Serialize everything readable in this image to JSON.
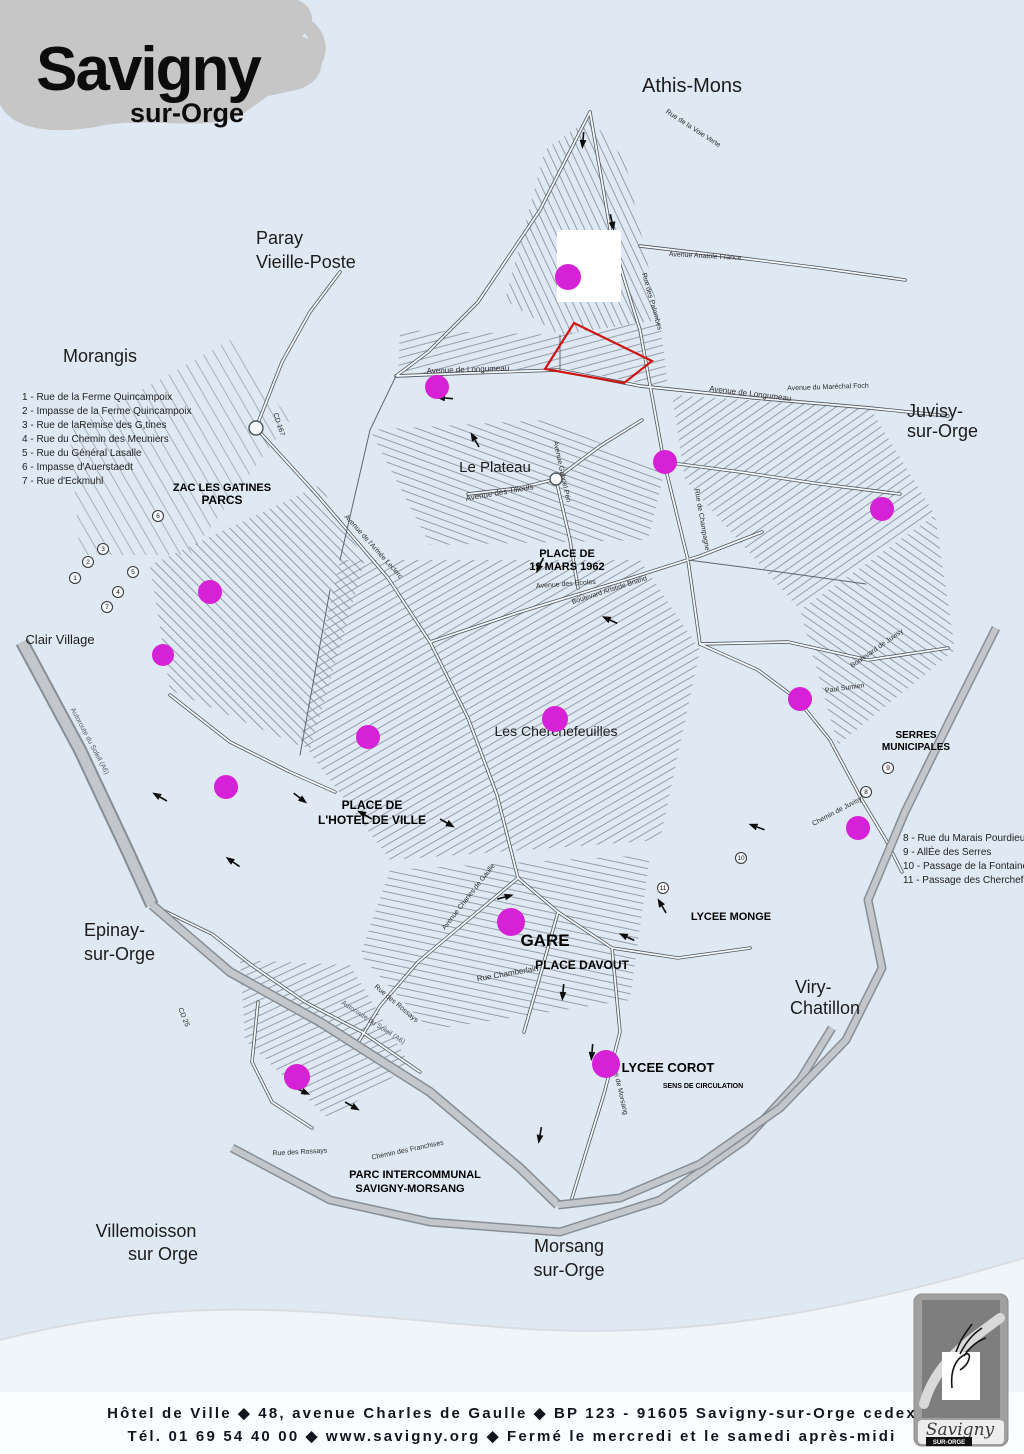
{
  "page": {
    "bg": "#dfe9f3"
  },
  "logo": {
    "title": "Savigny",
    "subtitle": "sur-Orge"
  },
  "footer": {
    "line1": "Hôtel de Ville ◆ 48, avenue Charles de Gaulle ◆ BP 123 - 91605 Savigny-sur-Orge cedex",
    "line2": "Tél. 01 69 54 40 00 ◆ www.savigny.org ◆ Fermé le mercredi et le samedi après-midi"
  },
  "badge_logo": {
    "title": "Savigny",
    "subtitle": "SUR-ORGE"
  },
  "map": {
    "legend_left": {
      "x": 22,
      "y": 400,
      "line_h": 14,
      "items": [
        "1 - Rue de la Ferme Quincampoix",
        "2 - Impasse de la Ferme Quincampoix",
        "3 - Rue de laRemise des G,tines",
        "4 - Rue du Chemin des Meuniers",
        "5 - Rue du Général Lasalle",
        "6 - Impasse d'Auerstaedt",
        "7 - Rue d'Eckmuhl"
      ]
    },
    "legend_right": {
      "x": 903,
      "y": 841,
      "line_h": 14,
      "items": [
        "8 - Rue du Marais Pourdieu",
        "9 - AllÉe des Serres",
        "10 - Passage de la Fontaine Blanch",
        "11 - Passage des Cherchefeuilles"
      ]
    },
    "towns": [
      {
        "text": "Athis-Mons",
        "x": 692,
        "y": 92,
        "size": 20
      },
      {
        "text": "Paray",
        "x": 256,
        "y": 244,
        "size": 18,
        "anchor": "start"
      },
      {
        "text": "Vieille-Poste",
        "x": 256,
        "y": 268,
        "size": 18,
        "anchor": "start"
      },
      {
        "text": "Morangis",
        "x": 100,
        "y": 362,
        "size": 18
      },
      {
        "text": "Juvisy-",
        "x": 907,
        "y": 417,
        "size": 18,
        "anchor": "start"
      },
      {
        "text": "sur-Orge",
        "x": 907,
        "y": 437,
        "size": 18,
        "anchor": "start"
      },
      {
        "text": "Clair Village",
        "x": 60,
        "y": 644,
        "size": 13
      },
      {
        "text": "Epinay-",
        "x": 84,
        "y": 936,
        "size": 18,
        "anchor": "start"
      },
      {
        "text": "sur-Orge",
        "x": 84,
        "y": 960,
        "size": 18,
        "anchor": "start"
      },
      {
        "text": "Viry-",
        "x": 795,
        "y": 993,
        "size": 18,
        "anchor": "start"
      },
      {
        "text": "Chatillon",
        "x": 790,
        "y": 1014,
        "size": 18,
        "anchor": "start"
      },
      {
        "text": "Villemoisson",
        "x": 146,
        "y": 1237,
        "size": 18
      },
      {
        "text": "sur Orge",
        "x": 163,
        "y": 1260,
        "size": 18
      },
      {
        "text": "Morsang",
        "x": 569,
        "y": 1252,
        "size": 18
      },
      {
        "text": "sur-Orge",
        "x": 569,
        "y": 1276,
        "size": 18
      }
    ],
    "places_bold": [
      {
        "text": "ZAC LES GATINES",
        "x": 222,
        "y": 491,
        "size": 11
      },
      {
        "text": "PARCS",
        "x": 222,
        "y": 504,
        "size": 12
      },
      {
        "text": "PLACE DE",
        "x": 567,
        "y": 557,
        "size": 11
      },
      {
        "text": "19 MARS 1962",
        "x": 567,
        "y": 570,
        "size": 11
      },
      {
        "text": "PLACE DE",
        "x": 372,
        "y": 809,
        "size": 12
      },
      {
        "text": "L'HOTEL DE VILLE",
        "x": 372,
        "y": 824,
        "size": 12
      },
      {
        "text": "GARE",
        "x": 545,
        "y": 946,
        "size": 17
      },
      {
        "text": "PLACE DAVOUT",
        "x": 582,
        "y": 969,
        "size": 12
      },
      {
        "text": "LYCEE MONGE",
        "x": 731,
        "y": 920,
        "size": 11
      },
      {
        "text": "LYCEE COROT",
        "x": 668,
        "y": 1072,
        "size": 13
      },
      {
        "text": "SENS DE CIRCULATION",
        "x": 703,
        "y": 1088,
        "size": 7
      },
      {
        "text": "SERRES",
        "x": 916,
        "y": 738,
        "size": 10
      },
      {
        "text": "MUNICIPALES",
        "x": 916,
        "y": 750,
        "size": 10
      },
      {
        "text": "PARC INTERCOMMUNAL",
        "x": 415,
        "y": 1178,
        "size": 11
      },
      {
        "text": "SAVIGNY-MORSANG",
        "x": 410,
        "y": 1192,
        "size": 11
      }
    ],
    "places_regular": [
      {
        "text": "Le Plateau",
        "x": 495,
        "y": 472,
        "size": 15
      },
      {
        "text": "Les Cherchefeuilles",
        "x": 556,
        "y": 736,
        "size": 14
      }
    ],
    "streets": [
      {
        "text": "Avenue de Longumeau",
        "x": 468,
        "y": 372,
        "rot": -2,
        "size": 8
      },
      {
        "text": "Avenue de Longumeau",
        "x": 750,
        "y": 396,
        "rot": 7,
        "size": 8
      },
      {
        "text": "Avenue des Tilleuls",
        "x": 500,
        "y": 495,
        "rot": -10,
        "size": 8
      },
      {
        "text": "Avenue Anatole France",
        "x": 705,
        "y": 258,
        "rot": 3,
        "size": 7
      },
      {
        "text": "Rue des Palombes",
        "x": 650,
        "y": 302,
        "rot": 74,
        "size": 7
      },
      {
        "text": "Avenue du Maréchal Foch",
        "x": 828,
        "y": 389,
        "rot": -2,
        "size": 7
      },
      {
        "text": "Rue de la Voie Verte",
        "x": 692,
        "y": 130,
        "rot": 33,
        "size": 7
      },
      {
        "text": "Avenue Charles de Gaulle",
        "x": 470,
        "y": 898,
        "rot": -52,
        "size": 7
      },
      {
        "text": "Rue Chamberlain",
        "x": 508,
        "y": 976,
        "rot": -10,
        "size": 8
      },
      {
        "text": "Chemin de Juvisy",
        "x": 838,
        "y": 813,
        "rot": -28,
        "size": 7
      },
      {
        "text": "Autoroute du Soleil (A6)",
        "x": 88,
        "y": 742,
        "rot": 62,
        "size": 7,
        "color": "#555a60"
      },
      {
        "text": "Autoroute du Soleil (A6)",
        "x": 372,
        "y": 1024,
        "rot": 33,
        "size": 7,
        "color": "#555a60"
      },
      {
        "text": "CD 167",
        "x": 277,
        "y": 425,
        "rot": 72,
        "size": 7
      },
      {
        "text": "CD 25",
        "x": 182,
        "y": 1018,
        "rot": 68,
        "size": 7
      },
      {
        "text": "Rue des Rossays",
        "x": 300,
        "y": 1154,
        "rot": -3,
        "size": 7
      },
      {
        "text": "Chemin des Franchises",
        "x": 408,
        "y": 1152,
        "rot": -12,
        "size": 7
      },
      {
        "text": "Rue de Morsang",
        "x": 618,
        "y": 1090,
        "rot": 77,
        "size": 7
      },
      {
        "text": "Boulevard Aristide Briand",
        "x": 610,
        "y": 592,
        "rot": -18,
        "size": 7
      },
      {
        "text": "Avenue Gabriel Péri",
        "x": 560,
        "y": 472,
        "rot": 78,
        "size": 7
      },
      {
        "text": "Rue de Champagne",
        "x": 700,
        "y": 520,
        "rot": 80,
        "size": 7
      },
      {
        "text": "Boulevard de Juvisy",
        "x": 878,
        "y": 650,
        "rot": -35,
        "size": 7
      },
      {
        "text": "Paul Sumien",
        "x": 845,
        "y": 690,
        "rot": -8,
        "size": 7
      },
      {
        "text": "Avenue des Ecoles",
        "x": 566,
        "y": 586,
        "rot": -4,
        "size": 7
      },
      {
        "text": "Avenue de l'Armée Leclerc",
        "x": 372,
        "y": 548,
        "rot": 48,
        "size": 7
      },
      {
        "text": "Rue des Rossays",
        "x": 395,
        "y": 1005,
        "rot": 40,
        "size": 7
      }
    ],
    "markers": {
      "color": "#d621d6",
      "points": [
        [
          568,
          277,
          13
        ],
        [
          437,
          387,
          12
        ],
        [
          665,
          462,
          12
        ],
        [
          882,
          509,
          12
        ],
        [
          210,
          592,
          12
        ],
        [
          163,
          655,
          11
        ],
        [
          800,
          699,
          12
        ],
        [
          555,
          719,
          13
        ],
        [
          368,
          737,
          12
        ],
        [
          226,
          787,
          12
        ],
        [
          858,
          828,
          12
        ],
        [
          511,
          922,
          14
        ],
        [
          606,
          1064,
          14
        ],
        [
          297,
          1077,
          13
        ]
      ]
    },
    "number_badges": [
      {
        "n": "1",
        "x": 75,
        "y": 578
      },
      {
        "n": "2",
        "x": 88,
        "y": 562
      },
      {
        "n": "3",
        "x": 103,
        "y": 549
      },
      {
        "n": "4",
        "x": 118,
        "y": 592
      },
      {
        "n": "5",
        "x": 133,
        "y": 572
      },
      {
        "n": "6",
        "x": 158,
        "y": 516
      },
      {
        "n": "7",
        "x": 107,
        "y": 607
      },
      {
        "n": "8",
        "x": 866,
        "y": 792
      },
      {
        "n": "9",
        "x": 888,
        "y": 768
      },
      {
        "n": "10",
        "x": 741,
        "y": 858
      },
      {
        "n": "11",
        "x": 663,
        "y": 888
      }
    ],
    "arrows": [
      [
        583,
        140,
        95
      ],
      [
        612,
        222,
        78
      ],
      [
        445,
        398,
        185
      ],
      [
        475,
        440,
        240
      ],
      [
        540,
        565,
        115
      ],
      [
        610,
        620,
        205
      ],
      [
        300,
        798,
        38
      ],
      [
        233,
        862,
        215
      ],
      [
        160,
        797,
        210
      ],
      [
        505,
        897,
        345
      ],
      [
        627,
        937,
        205
      ],
      [
        563,
        992,
        95
      ],
      [
        592,
        1052,
        95
      ],
      [
        352,
        1106,
        30
      ],
      [
        662,
        906,
        240
      ],
      [
        757,
        827,
        200
      ],
      [
        447,
        823,
        30
      ],
      [
        302,
        1091,
        25
      ],
      [
        540,
        1135,
        100
      ],
      [
        365,
        815,
        210
      ]
    ]
  }
}
